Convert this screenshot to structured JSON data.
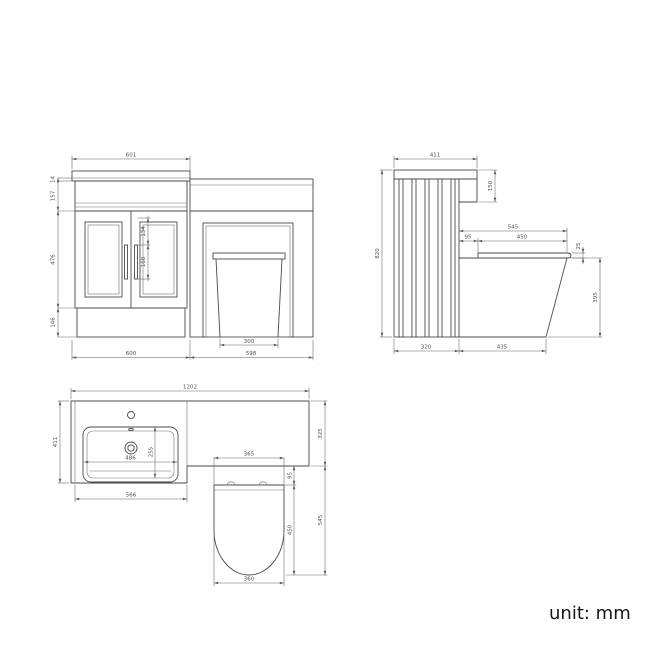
{
  "note": {
    "unit_label": "unit: mm"
  },
  "front": {
    "top_width": "601",
    "lip": "14",
    "apron": "157",
    "door_height": "476",
    "plinth": "146",
    "handle_offset": "134",
    "handle_height": "168",
    "pan_base": "300",
    "bottom_left": "600",
    "bottom_right": "598"
  },
  "side": {
    "top_depth": "411",
    "height": "820",
    "worktop_edge": "150",
    "seat_total": "545",
    "seat_gap": "95",
    "seat_length": "450",
    "seat_edge": "25",
    "pan_height": "395",
    "base_depth": "320",
    "pan_depth": "435"
  },
  "plan": {
    "overall_width": "1202",
    "vanity_depth": "411",
    "wc_depth": "325",
    "wc_projection": "545",
    "vanity_front": "566",
    "basin_width": "486",
    "basin_depth": "255",
    "seat_top_width": "365",
    "seat_gap": "95",
    "seat_length": "450",
    "seat_bottom_width": "360"
  }
}
